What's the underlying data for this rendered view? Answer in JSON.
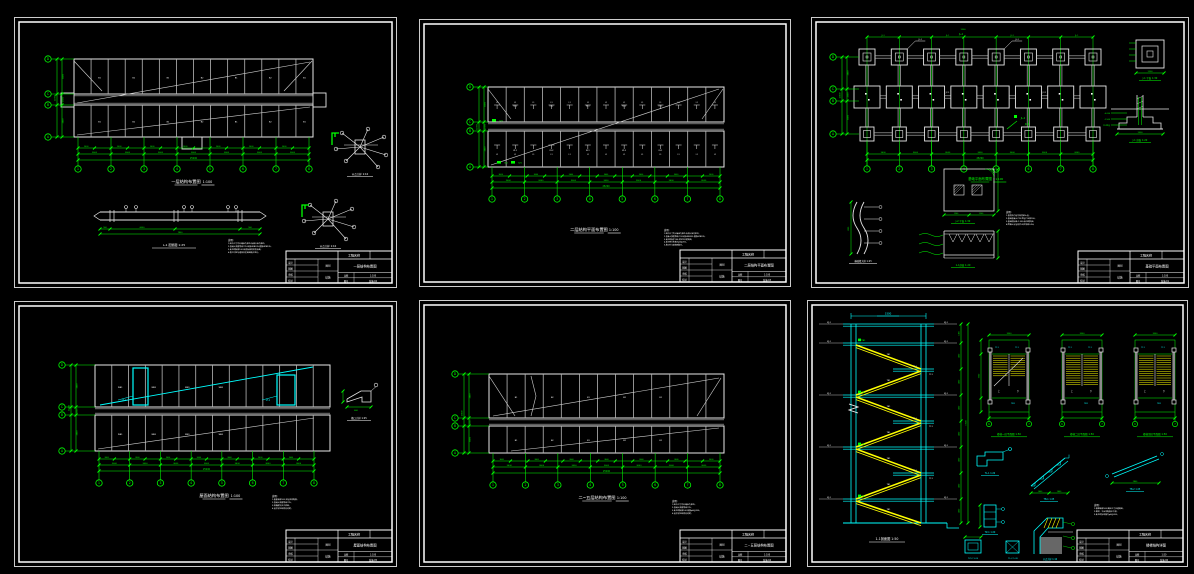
{
  "colors": {
    "bg": "#000000",
    "frame": "#ffffff",
    "line": "#e8e8e8",
    "beam": "#b8b8b8",
    "diag": "#d0d0d0",
    "dim": "#00ff00",
    "cyan": "#00ffff",
    "yellow": "#ffff00",
    "gray": "#8a8a8a",
    "text": "#ffffff"
  },
  "shared": {
    "col_bubbles": [
      "1",
      "2",
      "3",
      "4",
      "5",
      "6",
      "7",
      "8"
    ],
    "row_bubbles": [
      "D",
      "C",
      "B",
      "A"
    ],
    "bay_dim": "3600",
    "total_dim": "25200",
    "left_dims": [
      "4800",
      "2400",
      "4800"
    ],
    "left_total": "12000"
  },
  "sheets": [
    {
      "id": "s1",
      "caption": {
        "title": "一层结构布置图",
        "scale": "1:100"
      },
      "cells": [
        "B1",
        "B2",
        "B1",
        "B2",
        "B1",
        "B2",
        "B1"
      ],
      "beam": {
        "caption": "L-1 配筋图",
        "scale": "1:25",
        "dims": [
          "900",
          "6000",
          "900"
        ],
        "total": "7800"
      },
      "details": [
        {
          "caption": "节点大样 1:10"
        },
        {
          "caption": "节点大样 1:10"
        }
      ],
      "notes": {
        "header": "说明:",
        "lines": [
          "1.图中尺寸均以毫米为单位,标高以米为单位。",
          "2.混凝土强度等级C25,纵筋HRB335,箍筋HPB235。",
          "3.未注明板厚100,板底标高同梁底标高。",
          "4.施工时应与建筑及设备图配合进行。"
        ]
      },
      "titleblock": {
        "project_label": "工程名称",
        "fields": [
          "设计",
          "制图",
          "审核",
          "校对"
        ],
        "type_label": "图别",
        "type_value": "结施",
        "title": "一层结构布置图",
        "scale_label": "比例",
        "scale": "1:100",
        "no_label": "图号",
        "no": "结施-02"
      }
    },
    {
      "id": "s2",
      "caption": {
        "title": "二层结构平面布置图",
        "scale": "1:100"
      },
      "mark": "L1",
      "green_tags": [
        "GZ1",
        "GZ1",
        "GZ1"
      ],
      "cells": [
        "KL1",
        "KL2",
        "KL1",
        "KL2",
        "KL1"
      ],
      "notes": {
        "header": "说明:",
        "lines": [
          "1.图中尺寸均以毫米为单位,标高以米为单位。",
          "2.混凝土强度等级C25,纵筋HRB335,箍筋HPB235。",
          "3.未注明板厚100,梁定位见建筑图。",
          "4.未注明分布筋为φ8@200。",
          "5.施工时与建筑图配合。"
        ]
      },
      "titleblock": {
        "project_label": "工程名称",
        "fields": [
          "设计",
          "制图",
          "审核",
          "校对"
        ],
        "type_label": "图别",
        "type_value": "结施",
        "title": "二层结构平面布置图",
        "scale_label": "比例",
        "scale": "1:100",
        "no_label": "图号",
        "no": "结施-03"
      }
    },
    {
      "id": "s3",
      "caption": {
        "title": "基础平面布置图",
        "scale": "1:100"
      },
      "top_tag": "JL-1",
      "mid_tag": "JC-1",
      "cluster": [
        "JL-2",
        "JC-2"
      ],
      "footing_dim": "1200",
      "details": [
        {
          "caption": "J-1 平面 1:30"
        },
        {
          "caption": "J-1 剖面 1:20"
        },
        {
          "caption": "基础墙大样 1:25"
        },
        {
          "caption": "J-2 平面 1:30"
        },
        {
          "caption": "1-1剖面 1:20"
        }
      ],
      "section_tags": [
        "-0.050",
        "-1.500",
        "C10垫层"
      ],
      "notes": {
        "header": "说明:",
        "lines": [
          "1.基底持力层为粉质粘土层。",
          "2.基础混凝土C25,垫层C10厚100。",
          "3.基础底标高-1.500,未注明同此。",
          "4.回填土分层夯实,压实系数0.94。"
        ]
      },
      "titleblock": {
        "project_label": "工程名称",
        "fields": [
          "设计",
          "制图",
          "审核",
          "校对"
        ],
        "type_label": "图别",
        "type_value": "结施",
        "title": "基础平面布置图",
        "scale_label": "比例",
        "scale": "1:100",
        "no_label": "图号",
        "no": "结施-01"
      }
    },
    {
      "id": "s4",
      "caption": {
        "title": "屋面结构布置图",
        "scale": "1:100"
      },
      "cyan_tags": [
        "LT-1",
        "LT-1"
      ],
      "cells": [
        "WB1",
        "WB2",
        "WB1",
        "WB2"
      ],
      "detail": {
        "caption": "檐口大样 1:25",
        "dim": "600"
      },
      "notes": {
        "header": "说明:",
        "lines": [
          "1.屋面板厚100,双层双向配筋。",
          "2.混凝土强度等级C25。",
          "3.挑檐做法见大样图。",
          "4.其余详见结构总说明。"
        ]
      },
      "titleblock": {
        "project_label": "工程名称",
        "fields": [
          "设计",
          "制图",
          "审核",
          "校对"
        ],
        "type_label": "图别",
        "type_value": "结施",
        "title": "屋面结构布置图",
        "scale_label": "比例",
        "scale": "1:100",
        "no_label": "图号",
        "no": "结施-05"
      }
    },
    {
      "id": "s5",
      "caption": {
        "title": "二~五层结构布置图",
        "scale": "1:100"
      },
      "cells": [
        "B1",
        "B2",
        "B1",
        "B2",
        "B1"
      ],
      "notes": {
        "header": "说明:",
        "lines": [
          "1.图中尺寸均以毫米为单位。",
          "2.混凝土强度等级C25。",
          "3.未注明板厚100,配筋φ8@200。",
          "4.其余详见结构总说明。"
        ]
      },
      "titleblock": {
        "project_label": "工程名称",
        "fields": [
          "设计",
          "制图",
          "审核",
          "校对"
        ],
        "type_label": "图别",
        "type_value": "结施",
        "title": "二~五层结构布置图",
        "scale_label": "比例",
        "scale": "1:100",
        "no_label": "图号",
        "no": "结施-04"
      }
    },
    {
      "id": "s6",
      "section": {
        "caption": "1-1剖面图 1:50",
        "top_dim": "3300",
        "seg_dim": "1400",
        "flight": "TB1",
        "beam": "TL1",
        "plat": "PTB1",
        "level": "KJ-1",
        "elev": "3.600"
      },
      "plans": [
        {
          "caption": "楼梯一层平面图 1:50"
        },
        {
          "caption": "楼梯二层平面图 1:50"
        },
        {
          "caption": "楼梯顶层平面图 1:50"
        }
      ],
      "plan_tags": {
        "tl": "TL1",
        "tb": "TB1",
        "dir_up": "上",
        "dir_dn": "下",
        "width": "3300",
        "bubbles": [
          "6",
          "7"
        ]
      },
      "details": [
        {
          "caption": "TL-1 1:20"
        },
        {
          "caption": "TB-1 1:25"
        },
        {
          "caption": "TB-2 1:25"
        },
        {
          "caption": "TZ-1 1:20"
        },
        {
          "caption": "TZ-2 1:20"
        },
        {
          "caption": "TL-2 1:20"
        },
        {
          "caption": "节点大样 1:10"
        }
      ],
      "notes": {
        "header": "说明:",
        "lines": [
          "1.楼梯板厚100,踏步尺寸见建筑图。",
          "2.梯梁、平台梁配筋见大样。",
          "3.未注明分布筋为φ8@200。"
        ]
      },
      "titleblock": {
        "project_label": "工程名称",
        "fields": [
          "设计",
          "制图",
          "审核",
          "校对"
        ],
        "type_label": "图别",
        "type_value": "结施",
        "title": "楼梯结构详图",
        "scale_label": "比例",
        "scale": "1:50",
        "no_label": "图号",
        "no": "结施-06"
      }
    }
  ]
}
